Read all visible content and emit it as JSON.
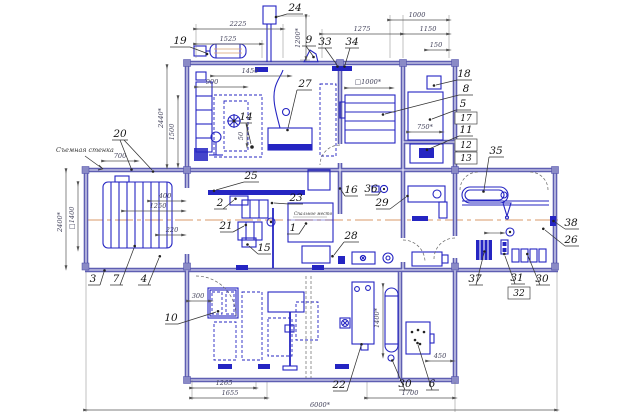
{
  "drawing": {
    "type": "engineering-floor-plan",
    "language": "ru",
    "colors": {
      "wall": "#5e5eb2",
      "equipment": "#2525c2",
      "dimension_text": "#44445c",
      "centerline": "#d89a68",
      "background": "#ffffff"
    },
    "annotations": {
      "removable_wall": "Съемная стенка",
      "sleeping_place": "Спальное место"
    },
    "callouts": {
      "c1": "1",
      "c2": "2",
      "c3": "3",
      "c4": "4",
      "c5": "5",
      "c6": "6",
      "c7": "7",
      "c8": "8",
      "c9": "9",
      "c10": "10",
      "c11": "11",
      "c12": "12",
      "c13": "13",
      "c14": "14",
      "c15": "15",
      "c16": "16",
      "c17": "17",
      "c18": "18",
      "c19": "19",
      "c20": "20",
      "c21": "21",
      "c22": "22",
      "c23": "23",
      "c24": "24",
      "c25": "25",
      "c26": "26",
      "c27": "27",
      "c28": "28",
      "c29": "29",
      "c30": "30",
      "c30b": "30",
      "c31": "31",
      "c32": "32",
      "c33": "33",
      "c34": "34",
      "c35": "35",
      "c36": "36",
      "c37": "37",
      "c38": "38"
    },
    "dimensions": {
      "d2225": "2225",
      "d1525": "1525",
      "d1200r": "1200*",
      "d1000": "1000",
      "d1275": "1275",
      "d1150": "1150",
      "d150": "150",
      "d2440": "2440*",
      "d1500": "1500",
      "d900": "900",
      "d1450": "1450",
      "d50": "50",
      "dsq1000": "□1000*",
      "d750": "750*",
      "d700": "700",
      "d400": "400",
      "d1250": "1250",
      "d220": "220",
      "d2400": "2400*",
      "dsq1400": "□1400",
      "d300": "300",
      "d1265": "1265",
      "d1655": "1655",
      "d1400": "1400*",
      "d450": "450",
      "d1700": "1700",
      "d6000": "6000*"
    }
  }
}
